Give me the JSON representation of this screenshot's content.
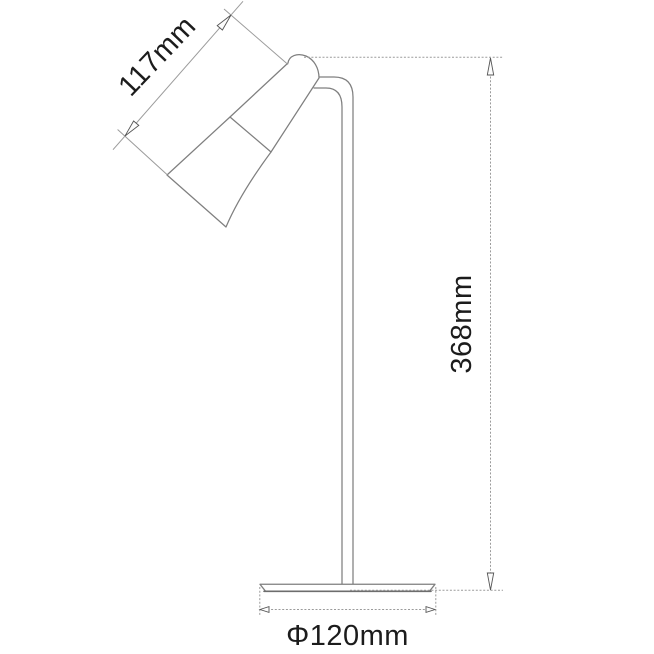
{
  "meta": {
    "description": "Technical dimension line drawing of a desk lamp, side view",
    "background_color": "#ffffff",
    "object_line_color": "#7f7f7f",
    "dimension_line_color": "#9b9b9b",
    "text_color": "#1c1c1c"
  },
  "lamp": {
    "parts": [
      "head-shade",
      "head-dome-cap",
      "pole",
      "base"
    ]
  },
  "dimensions": {
    "head_length": {
      "label": "117mm",
      "measures": "lamp head length, diagonal"
    },
    "height": {
      "label": "368mm",
      "measures": "overall lamp height, vertical"
    },
    "base_diameter": {
      "label": "Φ120mm",
      "measures": "base diameter, horizontal"
    }
  }
}
